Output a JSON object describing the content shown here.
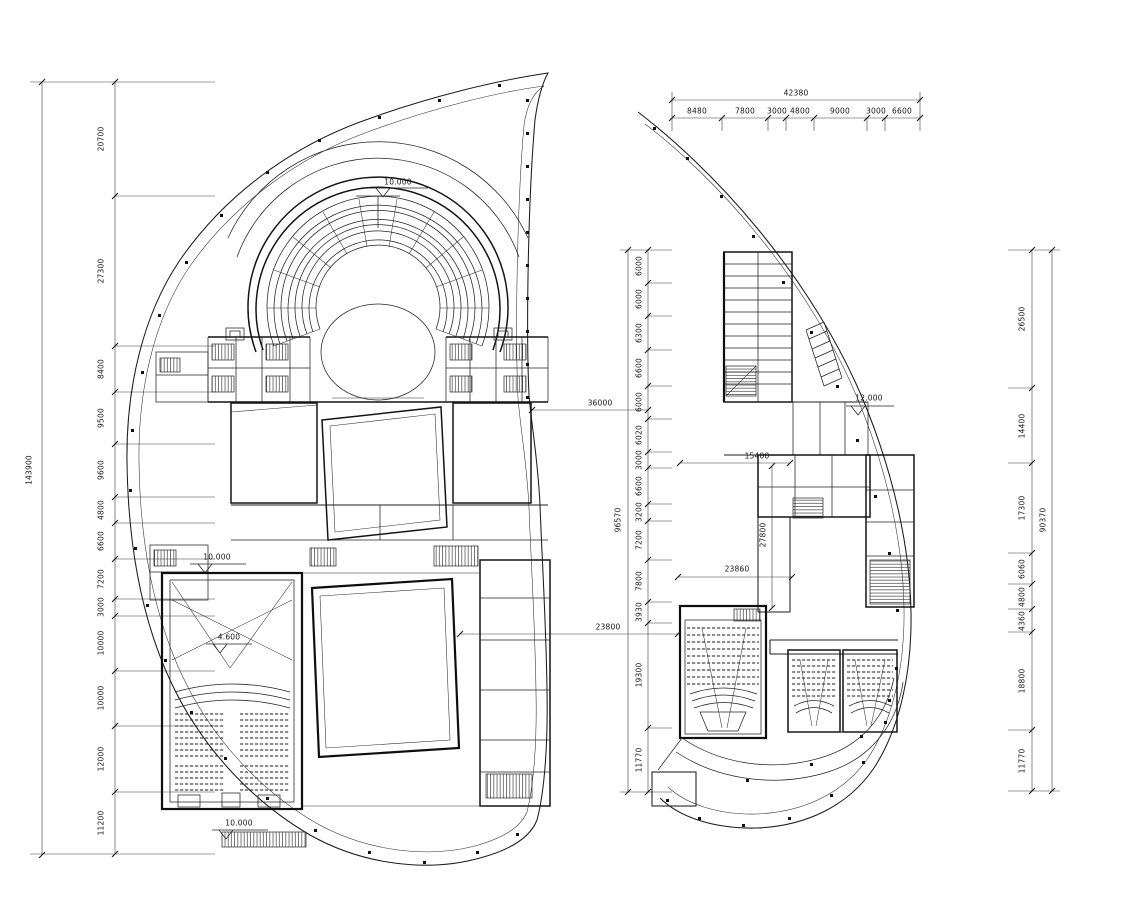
{
  "dims": {
    "left_total": "143900",
    "left_segments": [
      "20700",
      "27300",
      "8400",
      "9500",
      "9600",
      "4800",
      "6600",
      "7200",
      "3000",
      "10000",
      "10000",
      "12000",
      "11200"
    ],
    "top_total": "42380",
    "top_segments": [
      "8480",
      "7800",
      "3000",
      "4800",
      "9000",
      "3000",
      "6600"
    ],
    "mid_total": "96570",
    "mid_segments": [
      "6000",
      "6000",
      "6300",
      "6600",
      "6000",
      "6020",
      "3000",
      "6600",
      "3200",
      "7200",
      "7800",
      "3930",
      "19300",
      "11770"
    ],
    "right_total": "90370",
    "right_segments": [
      "26500",
      "14400",
      "17300",
      "6060",
      "4800",
      "4360",
      "18800",
      "11770"
    ],
    "span_36000": "36000",
    "span_15400": "15400",
    "span_27800": "27800",
    "span_23860": "23860",
    "span_23800": "23800"
  },
  "levels": {
    "stage_top": "10.000",
    "hall_left": "10.000",
    "hall_inner": "4.600",
    "stairs_bottom": "10.000",
    "right_wing": "12.000"
  }
}
